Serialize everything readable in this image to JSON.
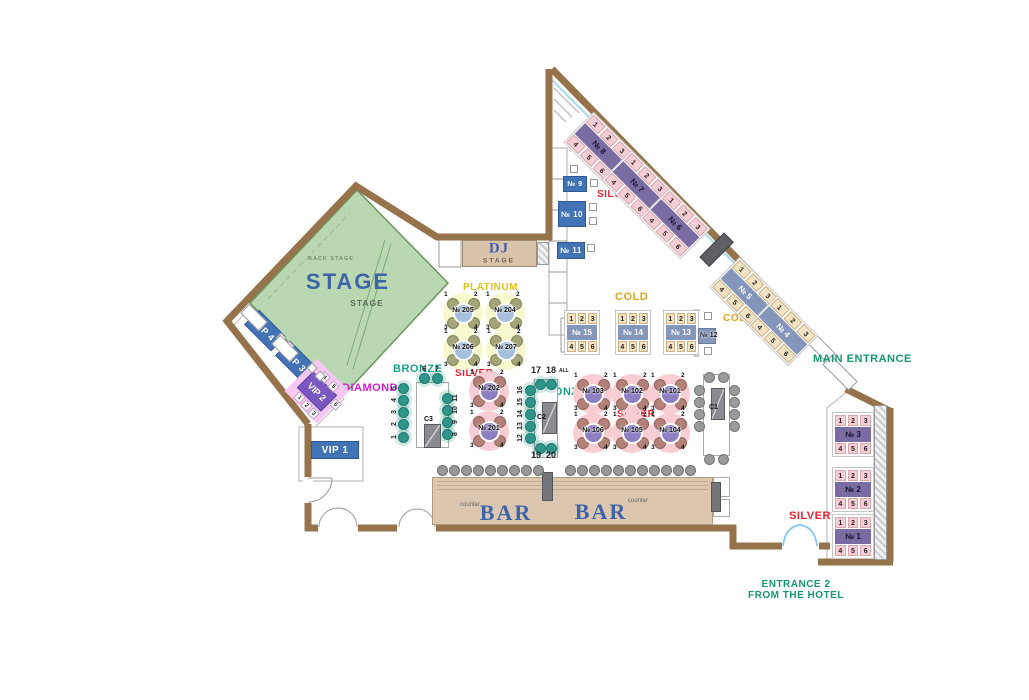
{
  "areas": {
    "stage": {
      "big": "STAGE",
      "small": "STAGE",
      "back": "BACK STAGE"
    },
    "dj": {
      "title": "DJ",
      "sub": "STAGE"
    },
    "bar": {
      "label_left": "BAR",
      "label_right": "BAR",
      "counter_left": "counter",
      "counter_right": "counter"
    }
  },
  "colors": {
    "wall": "#96734b",
    "stage_green": "#b9d8b2",
    "silver": "#e8232e",
    "cold": "#d8a81e",
    "platinum": "#dfc11f",
    "bronze": "#18a189",
    "diamond": "#d01fd0",
    "entrance": "#13986f",
    "table_blue": "#4273b4",
    "silver_bar": "#7b6ba3",
    "cold_bar": "#8496ba",
    "bar_tan": "#dcc6b0"
  },
  "category_labels": [
    {
      "id": "platinum",
      "text": "PLATINUM",
      "x": 463,
      "y": 283,
      "size": 10,
      "color": "#dfc11f"
    },
    {
      "id": "silver-top",
      "text": "SILVER",
      "x": 597,
      "y": 190,
      "size": 10,
      "color": "#e8232e"
    },
    {
      "id": "silver-mid",
      "text": "SILVER",
      "x": 455,
      "y": 369,
      "size": 10,
      "color": "#e8232e"
    },
    {
      "id": "silver-center",
      "text": "SILVER",
      "x": 617,
      "y": 410,
      "size": 10,
      "color": "#e8232e"
    },
    {
      "id": "silver-right",
      "text": "SILVER",
      "x": 789,
      "y": 511,
      "size": 11,
      "color": "#e8232e"
    },
    {
      "id": "cold-left",
      "text": "COLD",
      "x": 615,
      "y": 292,
      "size": 11,
      "color": "#d8a81e"
    },
    {
      "id": "cold-right",
      "text": "COLD",
      "x": 723,
      "y": 314,
      "size": 10,
      "color": "#d8a81e"
    },
    {
      "id": "bronze-left",
      "text": "BRONZE",
      "x": 393,
      "y": 364,
      "size": 11,
      "color": "#18a189"
    },
    {
      "id": "bronze-center",
      "text": "BRONZE",
      "x": 537,
      "y": 387,
      "size": 11,
      "color": "#18a189"
    },
    {
      "id": "diamond",
      "text": "DIAMOND",
      "x": 342,
      "y": 383,
      "size": 11,
      "color": "#d01fd0"
    },
    {
      "id": "main-entrance",
      "text": "MAIN ENTRANCE",
      "x": 813,
      "y": 354,
      "size": 11,
      "color": "#13986f"
    },
    {
      "id": "entrance2-line1",
      "text": "ENTRANCE 2",
      "x": 796,
      "y": 580,
      "size": 10,
      "color": "#13986f",
      "center": true
    },
    {
      "id": "entrance2-line2",
      "text": "FROM THE HOTEL",
      "x": 796,
      "y": 591,
      "size": 10,
      "color": "#13986f",
      "center": true
    }
  ],
  "banquettes": [
    {
      "id": "8",
      "label": "№ 8",
      "x": 599,
      "y": 146,
      "w": 58,
      "rot": 45,
      "cls": "silver",
      "top": [
        "1",
        "2",
        "3"
      ],
      "bottom": [
        "4",
        "5",
        "6"
      ]
    },
    {
      "id": "7",
      "label": "№ 7",
      "x": 637,
      "y": 184,
      "w": 58,
      "rot": 45,
      "cls": "silver",
      "top": [
        "1",
        "2",
        "3"
      ],
      "bottom": [
        "4",
        "5",
        "6"
      ]
    },
    {
      "id": "6",
      "label": "№ 6",
      "x": 675,
      "y": 222,
      "w": 58,
      "rot": 45,
      "cls": "silver",
      "top": [
        "1",
        "2",
        "3"
      ],
      "bottom": [
        "4",
        "5",
        "6"
      ]
    },
    {
      "id": "5",
      "label": "№ 5",
      "x": 745,
      "y": 291,
      "w": 58,
      "rot": 45,
      "cls": "cold",
      "top": [
        "1",
        "2",
        "3"
      ],
      "bottom": [
        "4",
        "5",
        "6"
      ]
    },
    {
      "id": "4",
      "label": "№ 4",
      "x": 783,
      "y": 329,
      "w": 58,
      "rot": 45,
      "cls": "cold",
      "top": [
        "1",
        "2",
        "3"
      ],
      "bottom": [
        "4",
        "5",
        "6"
      ]
    },
    {
      "id": "3",
      "label": "№ 3",
      "x": 853,
      "y": 437,
      "w": 42,
      "pad": true,
      "cls": "silver",
      "top": [
        "1",
        "2",
        "3"
      ],
      "bottom": [
        "4",
        "5",
        "6"
      ]
    },
    {
      "id": "2",
      "label": "№ 2",
      "x": 853,
      "y": 492,
      "w": 42,
      "pad": true,
      "cls": "silver",
      "top": [
        "1",
        "2",
        "3"
      ],
      "bottom": [
        "4",
        "5",
        "6"
      ]
    },
    {
      "id": "1",
      "label": "№ 1",
      "x": 853,
      "y": 539,
      "w": 42,
      "pad": true,
      "cls": "silver",
      "top": [
        "1",
        "2",
        "3"
      ],
      "bottom": [
        "4",
        "5",
        "6"
      ]
    },
    {
      "id": "15",
      "label": "№ 15",
      "x": 582,
      "y": 335,
      "w": 36,
      "pad": true,
      "cls": "cold",
      "top": [
        "1",
        "2",
        "3"
      ],
      "bottom": [
        "4",
        "5",
        "6"
      ]
    },
    {
      "id": "14",
      "label": "№ 14",
      "x": 633,
      "y": 335,
      "w": 36,
      "pad": true,
      "cls": "cold",
      "top": [
        "1",
        "2",
        "3"
      ],
      "bottom": [
        "4",
        "5",
        "6"
      ]
    },
    {
      "id": "13",
      "label": "№ 13",
      "x": 681,
      "y": 335,
      "w": 36,
      "pad": true,
      "cls": "cold",
      "top": [
        "1",
        "2",
        "3"
      ],
      "bottom": [
        "4",
        "5",
        "6"
      ]
    }
  ],
  "blue_boxes": [
    {
      "id": "9",
      "label": "№ 9",
      "x": 563,
      "y": 176,
      "w": 24,
      "h": 16,
      "fs": 7
    },
    {
      "id": "10",
      "label": "№ 10",
      "x": 558,
      "y": 201,
      "w": 28,
      "h": 26,
      "fs": 8
    },
    {
      "id": "11",
      "label": "№ 11",
      "x": 557,
      "y": 242,
      "w": 28,
      "h": 17,
      "fs": 8
    },
    {
      "id": "vip1",
      "label": "VIP 1",
      "x": 311,
      "y": 441,
      "w": 48,
      "h": 18,
      "fs": 10
    },
    {
      "id": "vip4",
      "label": "VIP 4",
      "x": 246,
      "y": 320,
      "w": 38,
      "h": 21,
      "rot": 45,
      "fs": 9
    },
    {
      "id": "vip3",
      "label": "VIP 3",
      "x": 277,
      "y": 351,
      "w": 38,
      "h": 21,
      "rot": 45,
      "fs": 9
    }
  ],
  "round_tables": [
    {
      "id": "205",
      "label": "№ 205",
      "x": 463,
      "y": 313,
      "cls": "platinum",
      "seats": [
        "1",
        "2",
        "3",
        "4"
      ]
    },
    {
      "id": "204",
      "label": "№ 204",
      "x": 505,
      "y": 313,
      "cls": "platinum",
      "seats": [
        "1",
        "2",
        "3",
        "4"
      ]
    },
    {
      "id": "206",
      "label": "№ 206",
      "x": 463,
      "y": 350,
      "cls": "platinum",
      "seats": [
        "1",
        "2",
        "3",
        "4"
      ]
    },
    {
      "id": "207",
      "label": "№ 207",
      "x": 506,
      "y": 350,
      "cls": "platinum",
      "seats": [
        "1",
        "2",
        "3",
        "4"
      ]
    },
    {
      "id": "202",
      "label": "№ 202",
      "x": 489,
      "y": 391,
      "cls": "silver",
      "seats": [
        "1",
        "2",
        "3",
        "4"
      ]
    },
    {
      "id": "201",
      "label": "№ 201",
      "x": 489,
      "y": 431,
      "cls": "silver",
      "seats": [
        "1",
        "2",
        "3",
        "4"
      ]
    },
    {
      "id": "103",
      "label": "№ 103",
      "x": 593,
      "y": 394,
      "cls": "silver",
      "seats": [
        "1",
        "2",
        "3",
        "4"
      ]
    },
    {
      "id": "102",
      "label": "№ 102",
      "x": 632,
      "y": 394,
      "cls": "silver",
      "seats": [
        "1",
        "2",
        "3",
        "4"
      ]
    },
    {
      "id": "101",
      "label": "№ 101",
      "x": 670,
      "y": 394,
      "cls": "silver",
      "seats": [
        "1",
        "2",
        "3",
        "4"
      ]
    },
    {
      "id": "106",
      "label": "№ 106",
      "x": 593,
      "y": 433,
      "cls": "silver",
      "seats": [
        "1",
        "2",
        "3",
        "4"
      ]
    },
    {
      "id": "105",
      "label": "№ 105",
      "x": 632,
      "y": 433,
      "cls": "silver",
      "seats": [
        "1",
        "2",
        "3",
        "4"
      ]
    },
    {
      "id": "104",
      "label": "№ 104",
      "x": 670,
      "y": 433,
      "cls": "silver",
      "seats": [
        "1",
        "2",
        "3",
        "4"
      ]
    }
  ],
  "mini_table": {
    "id": "12",
    "label": "№ 12",
    "x": 698,
    "y": 328,
    "w": 18,
    "h": 16
  },
  "conference_tables": [
    {
      "id": "C3",
      "label": "C3",
      "cls": "teal",
      "rect": {
        "x": 416,
        "y": 382,
        "w": 33,
        "h": 66
      },
      "inner": {
        "x": 424,
        "y": 424,
        "w": 15,
        "h": 22
      },
      "label_pos": {
        "x": 424,
        "y": 416
      },
      "seats": [
        [
          403,
          388
        ],
        [
          403,
          400
        ],
        [
          403,
          412
        ],
        [
          403,
          424
        ],
        [
          403,
          437
        ],
        [
          424,
          378
        ],
        [
          437,
          378
        ],
        [
          447,
          398
        ],
        [
          447,
          410
        ],
        [
          447,
          422
        ],
        [
          447,
          434
        ]
      ],
      "nums": [
        {
          "t": "5",
          "x": 395,
          "y": 388,
          "r": -90
        },
        {
          "t": "4",
          "x": 395,
          "y": 400,
          "r": -90
        },
        {
          "t": "3",
          "x": 395,
          "y": 412,
          "r": -90
        },
        {
          "t": "2",
          "x": 395,
          "y": 424,
          "r": -90
        },
        {
          "t": "1",
          "x": 395,
          "y": 437,
          "r": -90
        },
        {
          "t": "6",
          "x": 424,
          "y": 370
        },
        {
          "t": "7",
          "x": 437,
          "y": 370
        },
        {
          "t": "11",
          "x": 456,
          "y": 398,
          "r": -90
        },
        {
          "t": "10",
          "x": 456,
          "y": 410,
          "r": -90
        },
        {
          "t": "9",
          "x": 456,
          "y": 422,
          "r": -90
        },
        {
          "t": "8",
          "x": 456,
          "y": 434,
          "r": -90
        }
      ],
      "caps": []
    },
    {
      "id": "C2",
      "label": "C2",
      "cls": "teal",
      "rect": {
        "x": 534,
        "y": 379,
        "w": 24,
        "h": 79
      },
      "inner": {
        "x": 542,
        "y": 402,
        "w": 13,
        "h": 30
      },
      "label_pos": {
        "x": 537,
        "y": 414
      },
      "seats": [
        [
          540,
          384
        ],
        [
          551,
          384
        ],
        [
          530,
          390
        ],
        [
          530,
          402
        ],
        [
          530,
          414
        ],
        [
          530,
          426
        ],
        [
          530,
          438
        ],
        [
          540,
          448
        ],
        [
          551,
          448
        ]
      ],
      "nums": [
        {
          "t": "16",
          "x": 521,
          "y": 390,
          "r": -90
        },
        {
          "t": "15",
          "x": 521,
          "y": 402,
          "r": -90
        },
        {
          "t": "14",
          "x": 521,
          "y": 414,
          "r": -90
        },
        {
          "t": "13",
          "x": 521,
          "y": 426,
          "r": -90
        },
        {
          "t": "12",
          "x": 521,
          "y": 438,
          "r": -90
        }
      ],
      "caps": [
        {
          "t": "17",
          "x": 531,
          "y": 366,
          "s": 9
        },
        {
          "t": "18",
          "x": 546,
          "y": 366,
          "s": 9
        },
        {
          "t": "ALL",
          "x": 559,
          "y": 369,
          "s": 5
        },
        {
          "t": "19",
          "x": 531,
          "y": 451,
          "s": 9
        },
        {
          "t": "20",
          "x": 546,
          "y": 451,
          "s": 9
        }
      ]
    },
    {
      "id": "C1",
      "label": "C1",
      "cls": "gray",
      "rect": {
        "x": 703,
        "y": 374,
        "w": 27,
        "h": 82
      },
      "inner": {
        "x": 711,
        "y": 388,
        "w": 12,
        "h": 30
      },
      "label_pos": {
        "x": 709,
        "y": 404
      },
      "seats": [
        [
          709,
          377
        ],
        [
          723,
          377
        ],
        [
          699,
          390
        ],
        [
          699,
          402
        ],
        [
          699,
          414
        ],
        [
          699,
          426
        ],
        [
          734,
          390
        ],
        [
          734,
          402
        ],
        [
          734,
          414
        ],
        [
          734,
          426
        ],
        [
          709,
          459
        ],
        [
          723,
          459
        ]
      ],
      "nums": [],
      "caps": []
    }
  ],
  "vip_diamond": {
    "label": "VIP 2",
    "glow": {
      "x": 317,
      "y": 391,
      "s": 46
    },
    "box": {
      "x": 317,
      "y": 391,
      "w": 34,
      "h": 23
    },
    "seats": [
      {
        "n": "4",
        "x": 320,
        "y": 373
      },
      {
        "n": "5",
        "x": 329,
        "y": 382
      },
      {
        "n": "6",
        "x": 331,
        "y": 400
      },
      {
        "n": "1",
        "x": 295,
        "y": 393
      },
      {
        "n": "2",
        "x": 302,
        "y": 401
      },
      {
        "n": "3",
        "x": 309,
        "y": 409
      }
    ]
  },
  "chairs": [
    {
      "x": 570,
      "y": 165
    },
    {
      "x": 590,
      "y": 179
    },
    {
      "x": 589,
      "y": 203
    },
    {
      "x": 589,
      "y": 217
    },
    {
      "x": 587,
      "y": 244
    },
    {
      "x": 704,
      "y": 312
    },
    {
      "x": 704,
      "y": 347
    },
    {
      "x": 277,
      "y": 334,
      "rot": 45
    },
    {
      "x": 285,
      "y": 342,
      "rot": 45
    },
    {
      "x": 308,
      "y": 364,
      "rot": 45
    },
    {
      "x": 316,
      "y": 372,
      "rot": 45
    }
  ],
  "sofas": [
    {
      "x": 241,
      "y": 311,
      "w": 26,
      "h": 13
    },
    {
      "x": 272,
      "y": 342,
      "w": 26,
      "h": 13
    }
  ],
  "stools": {
    "y": 470,
    "group1": [
      442,
      454,
      466,
      478,
      490,
      502,
      514,
      526,
      538
    ],
    "group2": [
      570,
      582,
      594,
      606,
      618,
      630,
      642,
      654,
      666,
      678,
      690
    ]
  }
}
